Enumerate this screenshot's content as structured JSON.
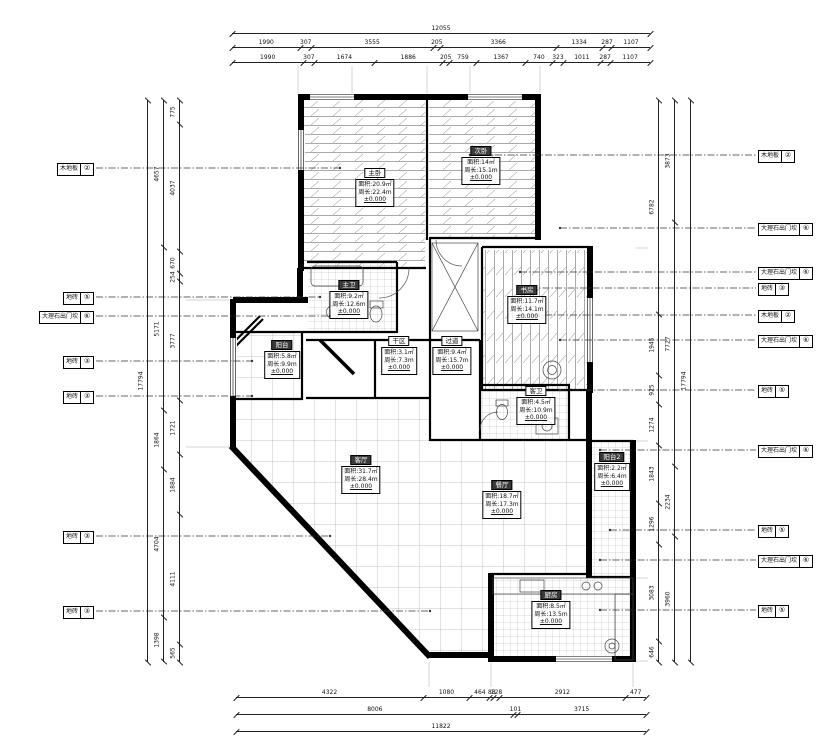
{
  "colors": {
    "wall": "#000000",
    "hatch": "#555555",
    "leader": "#333333",
    "room_label_dark_bg": "#3a3a3a"
  },
  "rooms": [
    {
      "name": "主卧",
      "area": "面积:20.9㎡",
      "perimeter": "周长:22.4m",
      "level": "±0.000"
    },
    {
      "name": "次卧",
      "area": "面积:14㎡",
      "perimeter": "周长:15.1m",
      "level": "±0.000"
    },
    {
      "name": "主卫",
      "area": "面积:9.2㎡",
      "perimeter": "周长:12.6m",
      "level": "±0.000"
    },
    {
      "name": "阳台",
      "area": "面积:5.8㎡",
      "perimeter": "周长:9.9m",
      "level": "±0.000"
    },
    {
      "name": "干区",
      "area": "面积:3.1㎡",
      "perimeter": "周长:7.3m",
      "level": "±0.000"
    },
    {
      "name": "过道",
      "area": "面积:9.4㎡",
      "perimeter": "周长:15.7m",
      "level": "±0.000"
    },
    {
      "name": "书房",
      "area": "面积:11.7㎡",
      "perimeter": "周长:14.1m",
      "level": "±0.000"
    },
    {
      "name": "客卫",
      "area": "面积:4.5㎡",
      "perimeter": "周长:10.9m",
      "level": "±0.000"
    },
    {
      "name": "客厅",
      "area": "面积:31.7㎡",
      "perimeter": "周长:28.4m",
      "level": "±0.000"
    },
    {
      "name": "餐厅",
      "area": "面积:18.7㎡",
      "perimeter": "周长:17.3m",
      "level": "±0.000"
    },
    {
      "name": "阳台2",
      "area": "面积:2.2㎡",
      "perimeter": "周长:6.4m",
      "level": "±0.000"
    },
    {
      "name": "厨房",
      "area": "面积:8.5㎡",
      "perimeter": "周长:13.5m",
      "level": "±0.000"
    }
  ],
  "materials_left": [
    {
      "label": "木地板",
      "num": "②"
    },
    {
      "label": "地砖",
      "num": "⑤"
    },
    {
      "label": "大理石出门坎",
      "num": "⑥"
    },
    {
      "label": "地砖",
      "num": "③"
    },
    {
      "label": "地砖",
      "num": "③"
    },
    {
      "label": "地砖",
      "num": "③"
    },
    {
      "label": "地砖",
      "num": "③"
    }
  ],
  "materials_right": [
    {
      "label": "木地板",
      "num": "②"
    },
    {
      "label": "大理石出门坎",
      "num": "⑥"
    },
    {
      "label": "大理石出门坎",
      "num": "⑥"
    },
    {
      "label": "地砖",
      "num": "③"
    },
    {
      "label": "木地板",
      "num": "②"
    },
    {
      "label": "大理石出门坎",
      "num": "⑥"
    },
    {
      "label": "地砖",
      "num": "⑤"
    },
    {
      "label": "大理石出门坎",
      "num": "⑥"
    },
    {
      "label": "地砖",
      "num": "⑤"
    },
    {
      "label": "大理石出门坎",
      "num": "⑥"
    },
    {
      "label": "地砖",
      "num": "⑤"
    }
  ],
  "dims": {
    "top_total": [
      "12055"
    ],
    "top_mid": [
      "1990",
      "307",
      "3555",
      "205",
      "3366",
      "1334",
      "287",
      "1107"
    ],
    "top_inner": [
      "1990",
      "307",
      "1674",
      "1886",
      "205",
      "759",
      "1367",
      "740",
      "323",
      "1011",
      "287",
      "1107"
    ],
    "bottom_inner": [
      "4322",
      "1080",
      "464",
      "88",
      "128",
      "2912",
      "477"
    ],
    "bottom_mid": [
      "8006",
      "101",
      "3715"
    ],
    "bottom_total": [
      "11822"
    ],
    "left_total": [
      "17794"
    ],
    "left_outer": [
      "4657",
      "5171",
      "1864",
      "4704",
      "1398"
    ],
    "left_inner": [
      "775",
      "4037",
      "670",
      "254",
      "3777",
      "1721",
      "1884",
      "4111",
      "565"
    ],
    "right_inner": [
      "6782",
      "1945",
      "925",
      "1274",
      "1843",
      "1296",
      "3083",
      "646"
    ],
    "right_outer": [
      "3873",
      "7727",
      "2234",
      "3960"
    ],
    "right_total": [
      "17794"
    ]
  }
}
